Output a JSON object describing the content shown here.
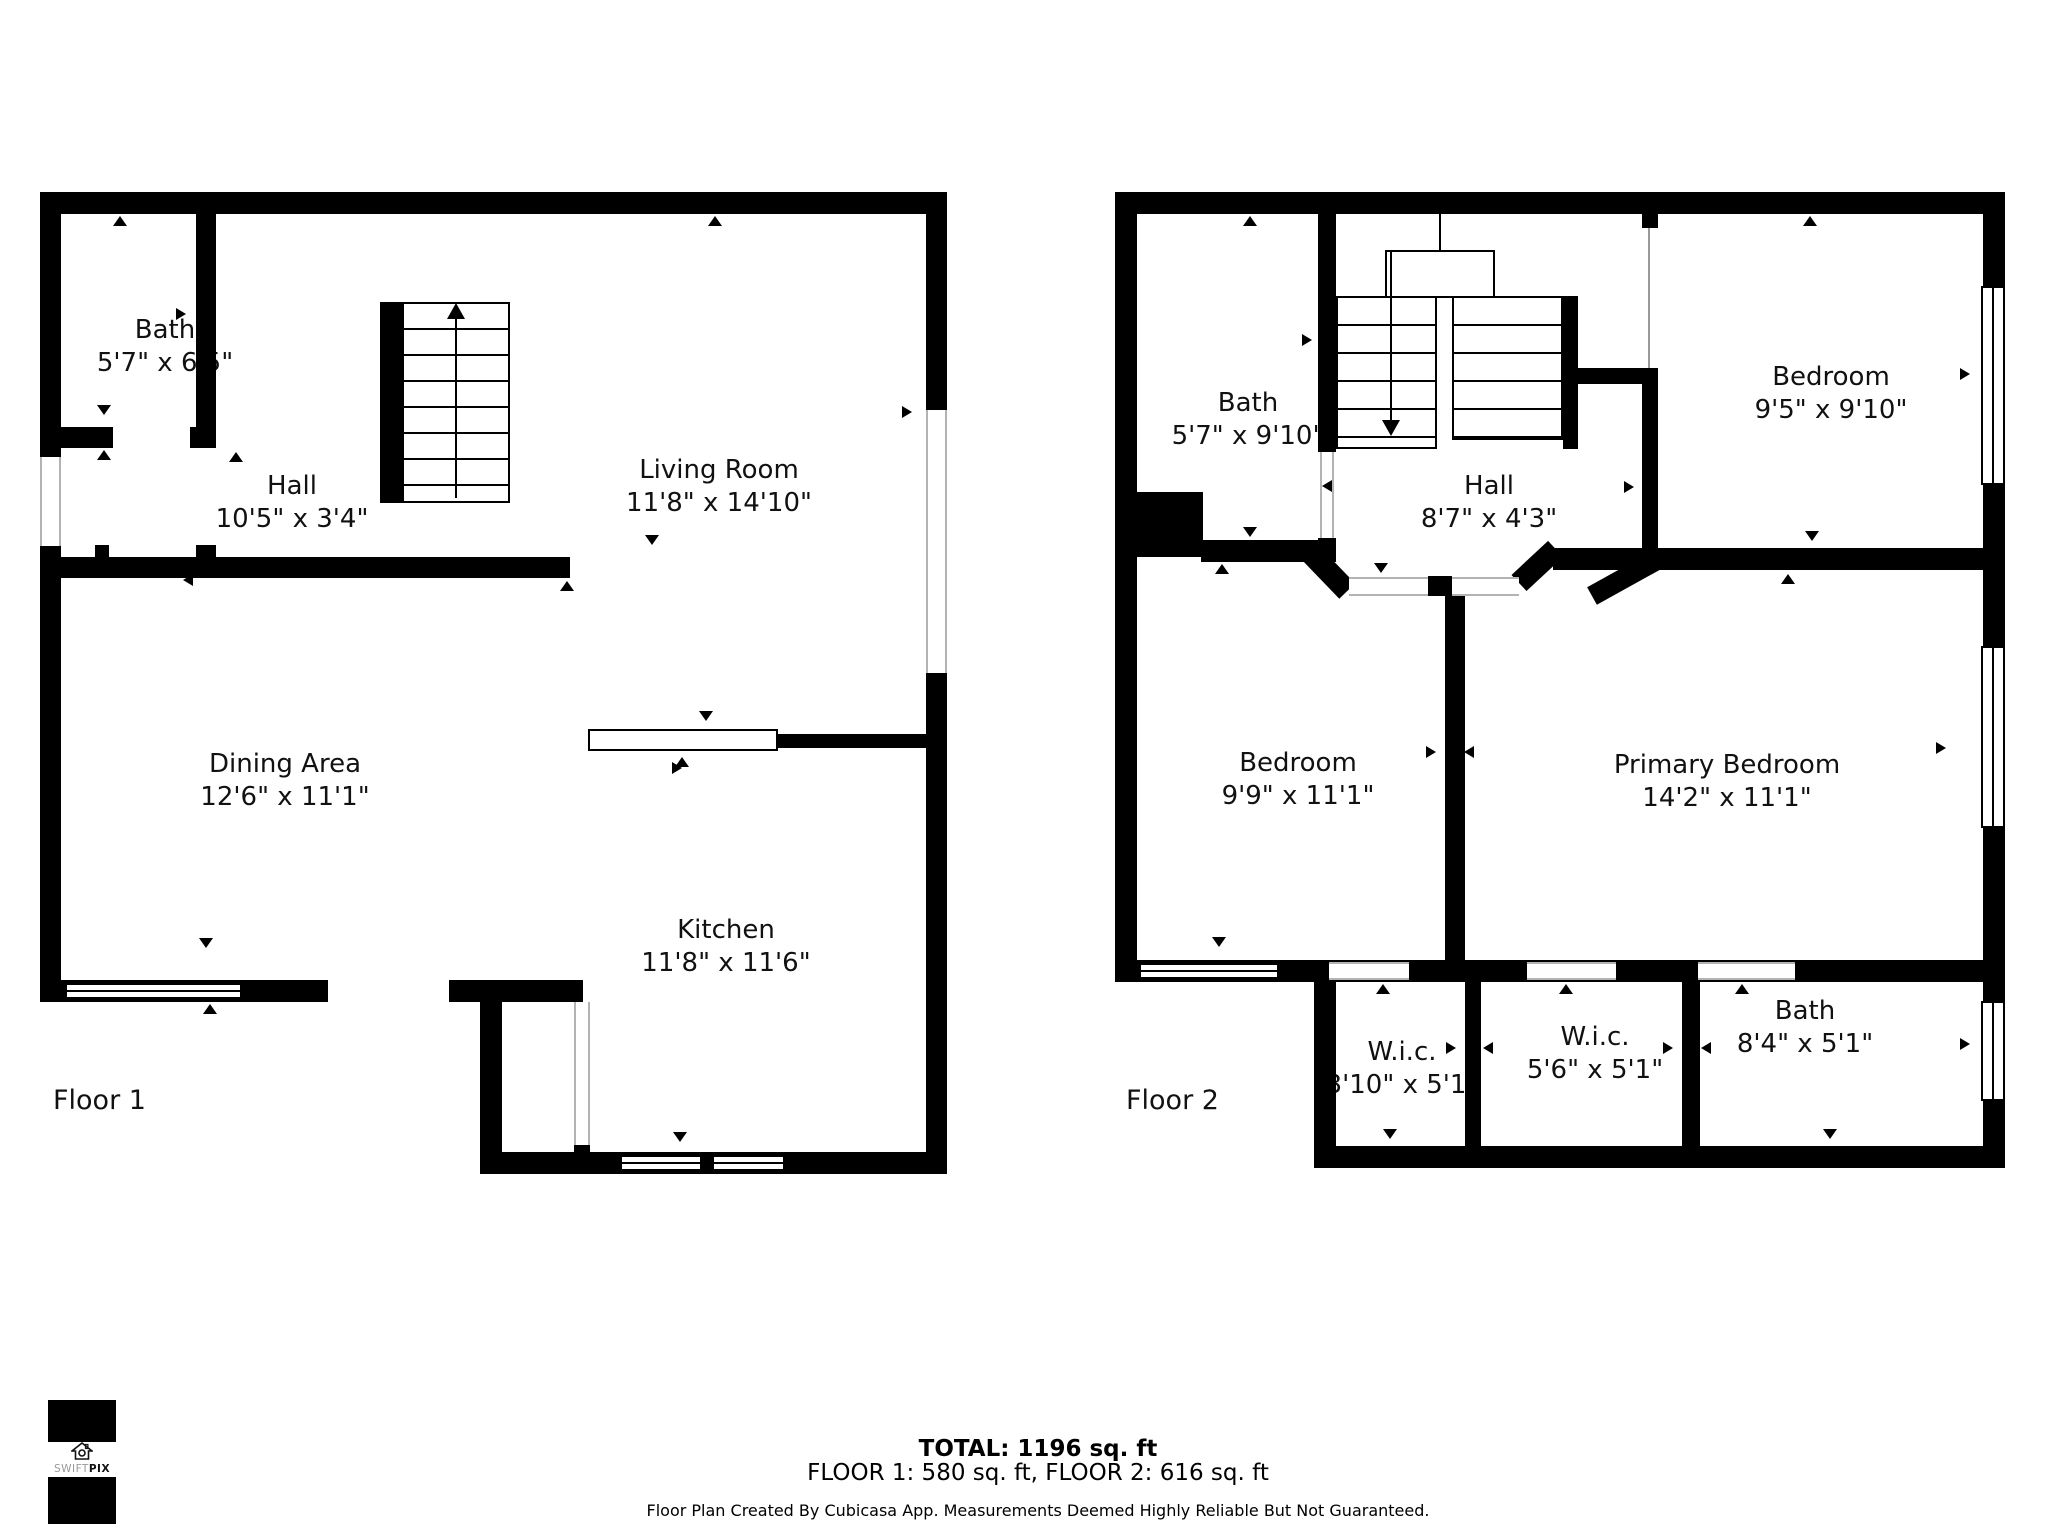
{
  "floors": [
    {
      "label": "Floor 1",
      "rooms": [
        {
          "name": "Bath",
          "dims": "5'7\" x 6'5\""
        },
        {
          "name": "Hall",
          "dims": "10'5\" x 3'4\""
        },
        {
          "name": "Living Room",
          "dims": "11'8\" x 14'10\""
        },
        {
          "name": "Dining Area",
          "dims": "12'6\" x 11'1\""
        },
        {
          "name": "Kitchen",
          "dims": "11'8\" x 11'6\""
        }
      ]
    },
    {
      "label": "Floor 2",
      "rooms": [
        {
          "name": "Bath",
          "dims": "5'7\" x 9'10\""
        },
        {
          "name": "Hall",
          "dims": "8'7\" x 4'3\""
        },
        {
          "name": "Bedroom",
          "dims": "9'5\" x 9'10\""
        },
        {
          "name": "Bedroom",
          "dims": "9'9\" x 11'1\""
        },
        {
          "name": "Primary Bedroom",
          "dims": "14'2\" x 11'1\""
        },
        {
          "name": "W.i.c.",
          "dims": "3'10\" x 5'1\""
        },
        {
          "name": "W.i.c.",
          "dims": "5'6\" x 5'1\""
        },
        {
          "name": "Bath",
          "dims": "8'4\" x 5'1\""
        }
      ]
    }
  ],
  "footer": {
    "total": "TOTAL: 1196 sq. ft",
    "floors": "FLOOR 1: 580 sq. ft, FLOOR 2: 616 sq. ft",
    "disclaimer": "Floor Plan Created By Cubicasa App. Measurements Deemed Highly Reliable But Not Guaranteed."
  },
  "logo": {
    "brand_swift": "SWIFT",
    "brand_pix": "PIX"
  },
  "colors": {
    "wall": "#000000",
    "text": "#111111",
    "background": "#ffffff",
    "door_line": "#b3b3b3"
  }
}
